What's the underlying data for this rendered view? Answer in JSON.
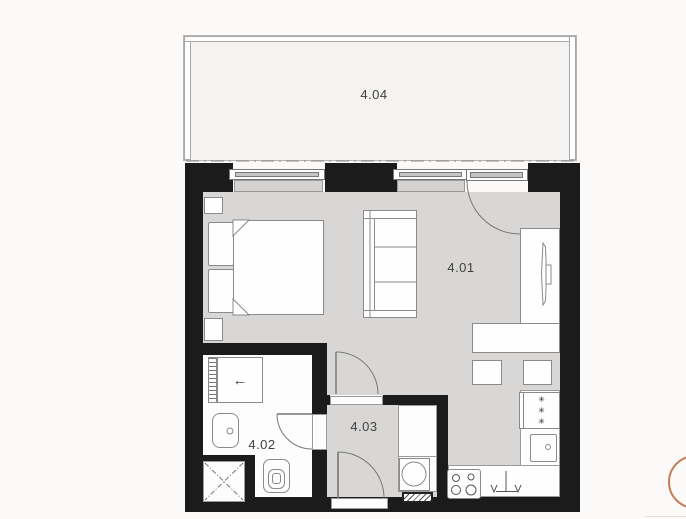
{
  "plan": {
    "type": "floor-plan",
    "rooms": {
      "living": {
        "label": "4.01"
      },
      "bathroom": {
        "label": "4.02"
      },
      "hallway": {
        "label": "4.03"
      },
      "balcony": {
        "label": "4.04"
      }
    },
    "symbols": {
      "wardrobe_arrow": "←",
      "freezer_star": "✳"
    },
    "colors": {
      "wall": "#1b1b1b",
      "floor": "#d8d7d6",
      "bathfloor": "#fdfdfd",
      "balconyfloor": "#f4f3f1",
      "line": "#8a8a8a",
      "sill": "#d4d3d1",
      "winband": "#c6c5c4",
      "label": "#3f3f3f",
      "accent": "#c47d58",
      "bg": "#fbfaf9"
    }
  }
}
